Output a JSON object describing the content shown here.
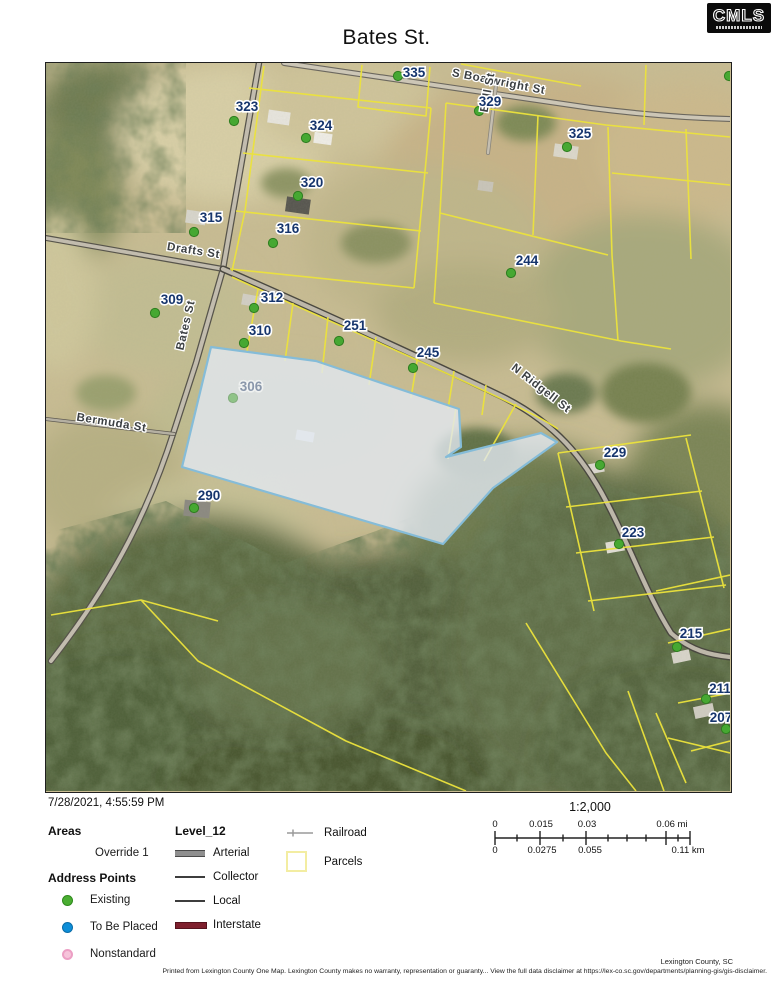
{
  "header": {
    "title": "Bates St.",
    "logo_text": "CMLS"
  },
  "map": {
    "colors": {
      "parcel_line": "#ece33c",
      "highlight_stroke": "#85bcd8",
      "highlight_fill": "rgba(226,233,241,0.8)",
      "address_point_green": "#46a832",
      "parcel_label_navy": "#16356d"
    },
    "parcels": [
      {
        "label": "323",
        "x": 201,
        "y": 48,
        "dot_x": 188,
        "dot_y": 58
      },
      {
        "label": "324",
        "x": 275,
        "y": 67,
        "dot_x": 260,
        "dot_y": 75
      },
      {
        "label": "335",
        "x": 368,
        "y": 14,
        "dot_x": 352,
        "dot_y": 13
      },
      {
        "label": "329",
        "x": 444,
        "y": 43,
        "dot_x": 433,
        "dot_y": 48
      },
      {
        "label": "325",
        "x": 534,
        "y": 75,
        "dot_x": 521,
        "dot_y": 84
      },
      {
        "label": "320",
        "x": 266,
        "y": 124,
        "dot_x": 252,
        "dot_y": 133
      },
      {
        "label": "315",
        "x": 165,
        "y": 159,
        "dot_x": 148,
        "dot_y": 169
      },
      {
        "label": "316",
        "x": 242,
        "y": 170,
        "dot_x": 227,
        "dot_y": 180
      },
      {
        "label": "244",
        "x": 481,
        "y": 202,
        "dot_x": 465,
        "dot_y": 210
      },
      {
        "label": "309",
        "x": 126,
        "y": 241,
        "dot_x": 109,
        "dot_y": 250
      },
      {
        "label": "312",
        "x": 226,
        "y": 239,
        "dot_x": 208,
        "dot_y": 245
      },
      {
        "label": "310",
        "x": 214,
        "y": 272,
        "dot_x": 198,
        "dot_y": 280
      },
      {
        "label": "251",
        "x": 309,
        "y": 267,
        "dot_x": 293,
        "dot_y": 278
      },
      {
        "label": "245",
        "x": 382,
        "y": 294,
        "dot_x": 367,
        "dot_y": 305
      },
      {
        "label": "306",
        "x": 205,
        "y": 328,
        "dot_x": 187,
        "dot_y": 335,
        "faint": true
      },
      {
        "label": "229",
        "x": 569,
        "y": 394,
        "dot_x": 554,
        "dot_y": 402
      },
      {
        "label": "290",
        "x": 163,
        "y": 437,
        "dot_x": 148,
        "dot_y": 445
      },
      {
        "label": "223",
        "x": 587,
        "y": 474,
        "dot_x": 573,
        "dot_y": 481
      },
      {
        "label": "215",
        "x": 645,
        "y": 575,
        "dot_x": 631,
        "dot_y": 584
      },
      {
        "label": "211",
        "x": 674,
        "y": 630,
        "dot_x": 660,
        "dot_y": 636
      },
      {
        "label": "207",
        "x": 675,
        "y": 659,
        "dot_x": 680,
        "dot_y": 666
      }
    ],
    "streets": [
      {
        "name": "Drafts  St",
        "x": 147,
        "y": 191,
        "angle": 9
      },
      {
        "name": "Bates St",
        "x": 143,
        "y": 263,
        "angle": -77
      },
      {
        "name": "Bermuda St",
        "x": 65,
        "y": 363,
        "angle": 9
      },
      {
        "name": "N Ridgell St",
        "x": 493,
        "y": 328,
        "angle": 38
      },
      {
        "name": "S Boatwright St",
        "x": 452,
        "y": 22,
        "angle": 11
      },
      {
        "name": "Ball St",
        "x": 445,
        "y": 30,
        "angle": -80
      }
    ],
    "extra_points": [
      {
        "x": 683,
        "y": 13
      }
    ]
  },
  "footer": {
    "timestamp": "7/28/2021, 4:55:59 PM",
    "scale_ratio": "1:2,000",
    "scalebar": {
      "mi": [
        "0",
        "0.015",
        "0.03",
        "0.06 mi"
      ],
      "km": [
        "0",
        "0.0275",
        "0.055",
        "0.11 km"
      ]
    },
    "legend": {
      "areas_header": "Areas",
      "override_label": "Override 1",
      "address_points_header": "Address Points",
      "points": [
        {
          "label": "Existing",
          "color": "#4aae32"
        },
        {
          "label": "To Be Placed",
          "color": "#0d8ed8"
        },
        {
          "label": "Nonstandard",
          "color": "#f6c3da"
        }
      ],
      "level_header": "Level_12",
      "roads": [
        {
          "label": "Arterial"
        },
        {
          "label": "Collector"
        },
        {
          "label": "Local"
        },
        {
          "label": "Interstate",
          "color": "#7e1f2d"
        }
      ],
      "railroad_label": "Railroad",
      "parcels_label": "Parcels"
    },
    "credit": "Lexington County, SC",
    "disclaimer": "Printed from Lexington County One Map. Lexington County makes no warranty, representation or guaranty... View the full data disclaimer at https://lex-co.sc.gov/departments/planning-gis/gis-disclaimer."
  }
}
